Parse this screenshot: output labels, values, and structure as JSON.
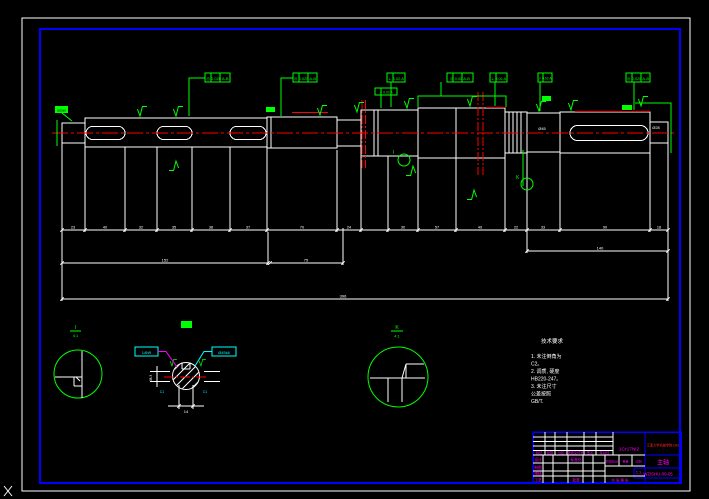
{
  "window": {
    "background": "#000000"
  },
  "colors": {
    "outline": "#ffffff",
    "frame_blue": "#0000ff",
    "annotation_green": "#00ff00",
    "centerline_red": "#ff0000",
    "section_cyan": "#00ffff",
    "leader_magenta": "#ff00ff"
  },
  "gdt": [
    "◎ 0.025 A-B",
    "◎ 0.025 A-B",
    "⊥ 0.02 A",
    "◎ 0.02 A-B",
    "⊥ 0.02 A",
    "↗ 0.02 A",
    "◎ 0.025 A-B",
    "↗ 0.02 A"
  ],
  "dims": {
    "chain": [
      "23",
      "40",
      "32",
      "35",
      "38",
      "37",
      "70",
      "24",
      "30",
      "57",
      "49",
      "22",
      "33",
      "90",
      "18"
    ],
    "mid1": "152",
    "mid2": "75",
    "mid3": "140",
    "overall": "396",
    "left_end": "Ø25k6",
    "right_end": "Ø28",
    "hub": "Ø45"
  },
  "section": {
    "box_left": "14N9",
    "box_right": "Ø45k6",
    "width": "14",
    "depth": "38.3",
    "chamfer_left": "C1",
    "chamfer_right": "C1"
  },
  "details": {
    "balloon1": "I",
    "balloon2": "K",
    "d1": {
      "label": "I",
      "scale": "4:1"
    },
    "d2": {
      "label": "K",
      "scale": "4:1"
    }
  },
  "notes": {
    "title": "技术要求",
    "lines": [
      "1. 未注倒角为",
      "C2。",
      "2. 调质, 硬度",
      "HB220-247。",
      "3. 未注尺寸",
      "公差按照",
      "GB/T."
    ]
  },
  "title_block": {
    "material": "1Cr17Ni2",
    "school": "江南大学机械学院1342",
    "part_name": "主轴",
    "drawing_no": "WZISHU-00-05",
    "rev_labels": [
      "标记",
      "处数",
      "分区",
      "更改文件号",
      "签名",
      "年月日"
    ],
    "sig_labels": [
      "设计",
      "制图",
      "审核",
      "工艺"
    ],
    "sig_labels2": [
      "标准化",
      "批准"
    ],
    "stage_label": "阶段标记",
    "weight_label": "重量",
    "scale_label": "比例",
    "scale_value": "1:1",
    "sheet_note": "共 张 第 张"
  }
}
